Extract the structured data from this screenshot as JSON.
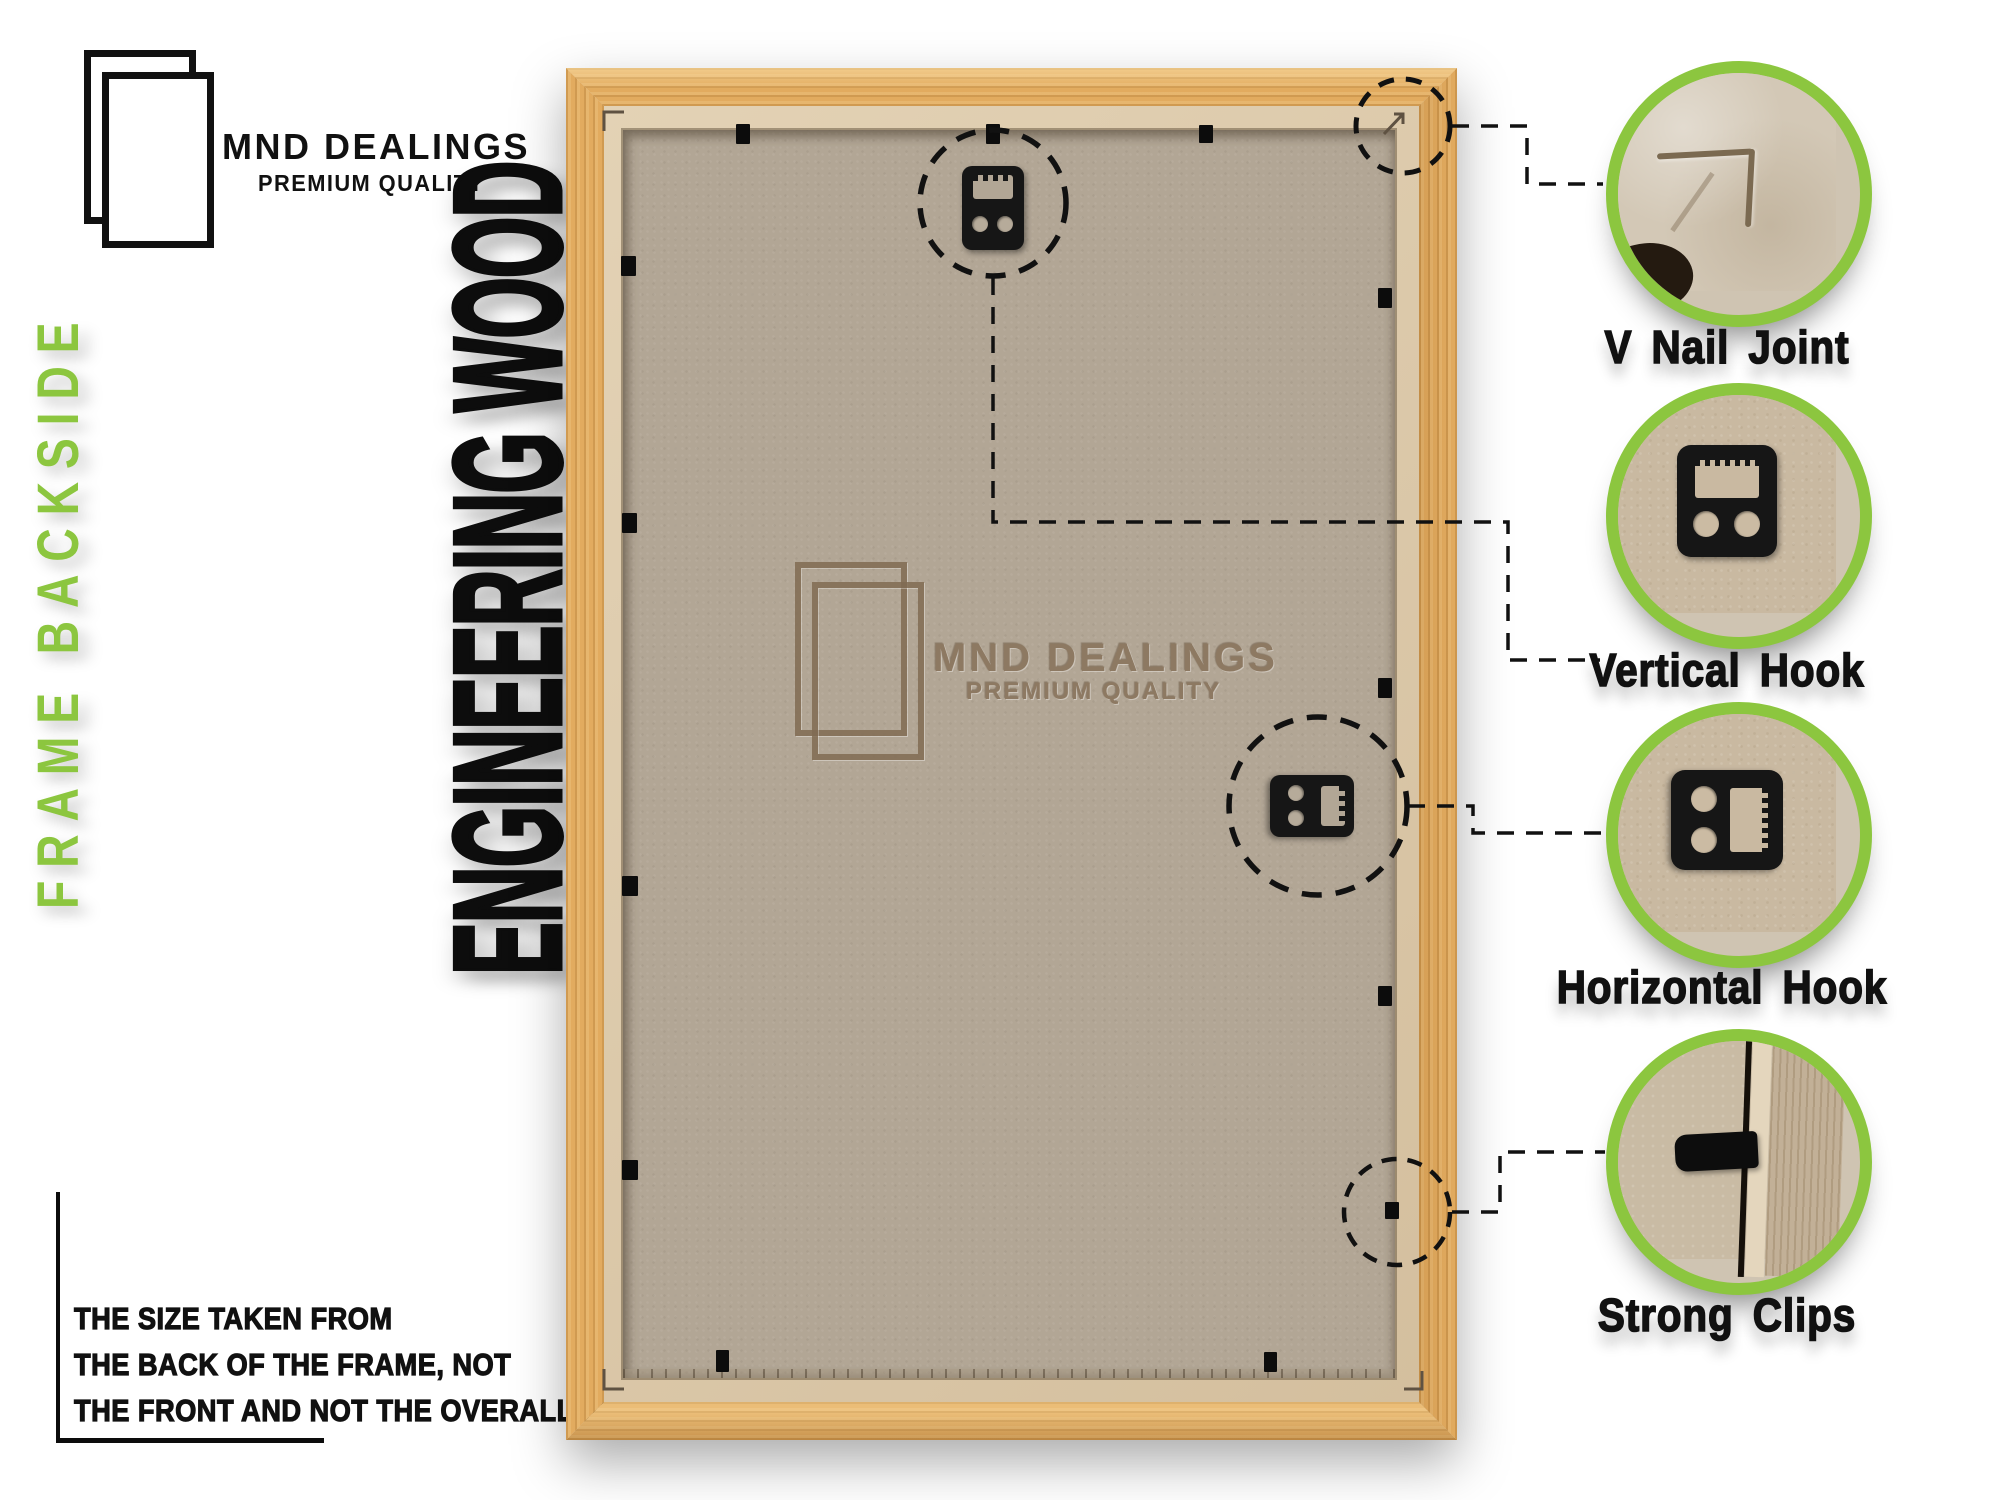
{
  "brand_header": {
    "name": "MND DEALINGS",
    "tagline": "PREMIUM QUALITY",
    "logo": "double-frame-outline-icon"
  },
  "left_panel": {
    "vertical_label": "FRAME BACKSIDE",
    "note_lines": [
      "THE SIZE TAKEN FROM",
      "THE BACK OF THE FRAME, NOT",
      "THE FRONT AND NOT THE OVERALL SIZE."
    ]
  },
  "material_banner": {
    "text": "ENGINEERING WOOD"
  },
  "frame_watermark": {
    "name": "MND DEALINGS",
    "tagline": "PREMIUM QUALITY",
    "logo": "double-frame-outline-icon"
  },
  "callouts": [
    {
      "label": "V Nail Joint",
      "photo": "wood-corner-v-nail-groove"
    },
    {
      "label": "Vertical Hook",
      "photo": "black-sawtooth-hanger-vertical"
    },
    {
      "label": "Horizontal Hook",
      "photo": "black-sawtooth-hanger-horizontal"
    },
    {
      "label": "Strong Clips",
      "photo": "black-clip-over-frame-edge"
    }
  ],
  "colors": {
    "accent_green": "#8CC63F",
    "ink": "#111111",
    "wood": "#e2ab5f",
    "mdf_lip": "#d8c5a7",
    "backboard": "#b2a695",
    "watermark_brown": "#8d7962"
  }
}
